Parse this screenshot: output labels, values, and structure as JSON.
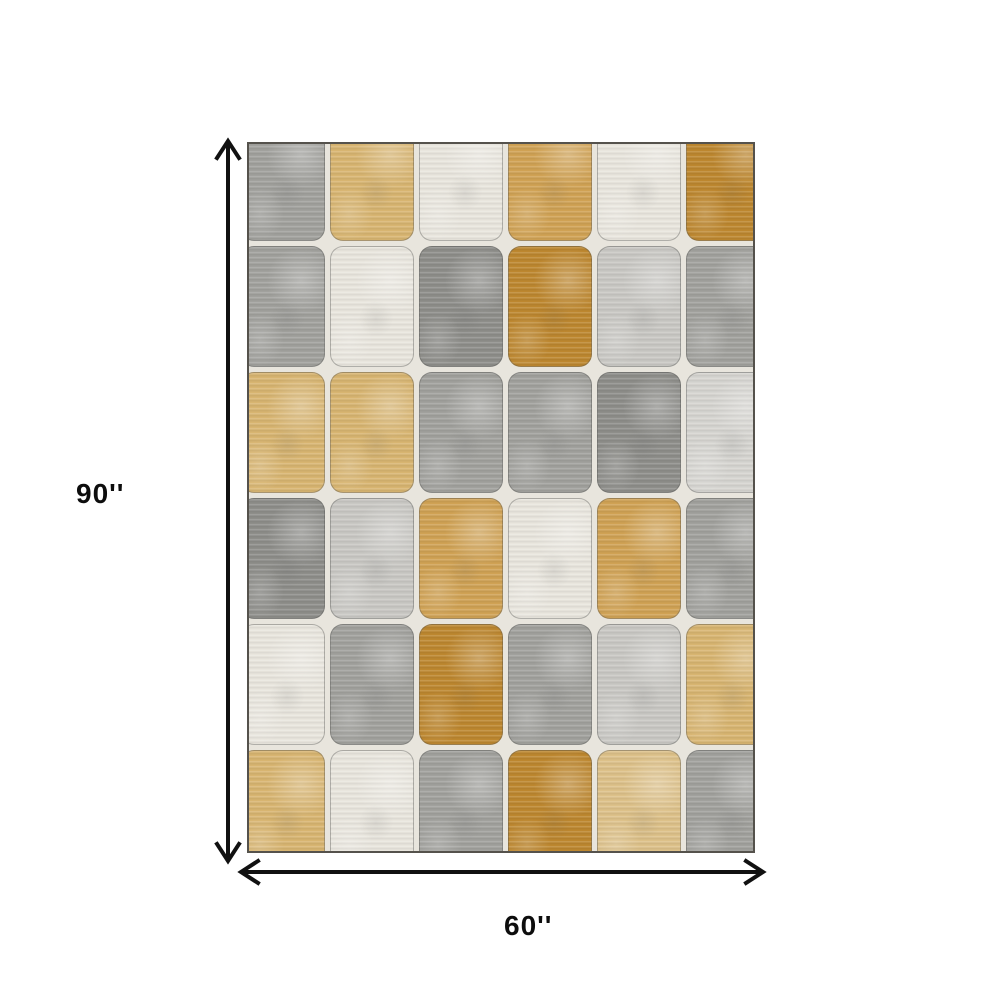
{
  "diagram": {
    "subject": "checkered-rug-top-view",
    "dimensions": {
      "height_label": "90''",
      "width_label": "60''"
    },
    "colors": {
      "canvas_background": "#ffffff",
      "arrow": "#111111",
      "label_text": "#0d0d0d",
      "rug_gap_background": "#e8e5dd",
      "rug_border": "#55524c"
    }
  },
  "rug": {
    "rows": 6,
    "cols": 6,
    "palette": {
      "gray": "#a1a19d",
      "grayDark": "#8e8e8a",
      "grayLight": "#c9c8c4",
      "grayLighter": "#d6d5d1",
      "cream": "#e9e6de",
      "tan": "#d8b571",
      "tanGold": "#d0a254",
      "tanLight": "#ddc189",
      "goldDark": "#bd872f"
    },
    "tiles": [
      [
        "gray",
        "tan",
        "cream",
        "tanGold",
        "cream",
        "goldDark"
      ],
      [
        "gray",
        "cream",
        "grayDark",
        "goldDark",
        "grayLight",
        "gray"
      ],
      [
        "tan",
        "tan",
        "gray",
        "gray",
        "grayDark",
        "grayLighter"
      ],
      [
        "grayDark",
        "grayLight",
        "tanGold",
        "cream",
        "tanGold",
        "gray"
      ],
      [
        "cream",
        "gray",
        "goldDark",
        "gray",
        "grayLight",
        "tan"
      ],
      [
        "tan",
        "cream",
        "gray",
        "goldDark",
        "tanLight",
        "gray"
      ]
    ]
  }
}
